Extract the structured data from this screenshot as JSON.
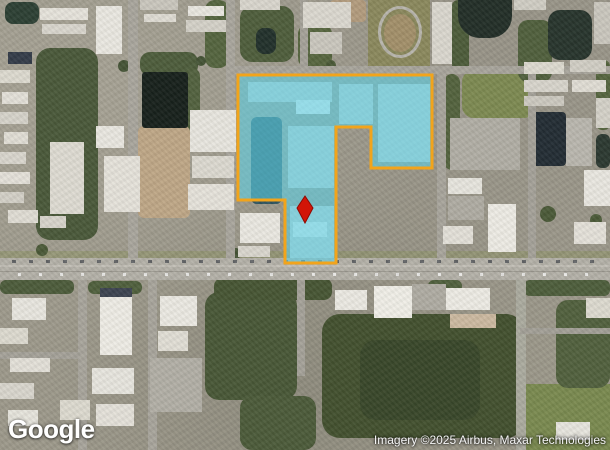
{
  "map": {
    "width": 610,
    "height": 450,
    "view_type": "satellite",
    "logo_text": "Google",
    "attribution_text": "Imagery ©2025 Airbus, Maxar Technologies",
    "parcel": {
      "stroke": "#F2A41B",
      "stroke_width": 3,
      "fill": "#3FC8E0",
      "fill_opacity": 0.5,
      "lighten_fill": "#FFFFFF",
      "lighten_opacity": 0.18,
      "points": [
        [
          238,
          75
        ],
        [
          432,
          75
        ],
        [
          432,
          168
        ],
        [
          371,
          168
        ],
        [
          371,
          127
        ],
        [
          336,
          127
        ],
        [
          336,
          263
        ],
        [
          285,
          263
        ],
        [
          285,
          200
        ],
        [
          238,
          200
        ]
      ]
    },
    "marker": {
      "color": "#D21507",
      "stroke": "#8F0A03",
      "points": [
        [
          305,
          196
        ],
        [
          313,
          208
        ],
        [
          305,
          223
        ],
        [
          297,
          208
        ]
      ]
    }
  },
  "features": {
    "ground": [
      {
        "x": 36,
        "y": 48,
        "w": 62,
        "h": 192,
        "c": "#4a593a",
        "rad": 14,
        "cls": "veg-shade"
      },
      {
        "x": 140,
        "y": 52,
        "w": 58,
        "h": 24,
        "c": "#4e5d3c",
        "rad": 10,
        "cls": "veg-shade"
      },
      {
        "x": 184,
        "y": 68,
        "w": 16,
        "h": 84,
        "c": "#53623f",
        "rad": 8
      },
      {
        "x": 205,
        "y": 0,
        "w": 24,
        "h": 68,
        "c": "#55653f",
        "rad": 10,
        "cls": "veg-shade"
      },
      {
        "x": 240,
        "y": 6,
        "w": 54,
        "h": 56,
        "c": "#4f5e3c",
        "rad": 12,
        "cls": "veg-shade"
      },
      {
        "x": 298,
        "y": 24,
        "w": 34,
        "h": 44,
        "c": "#57663f",
        "rad": 10
      },
      {
        "x": 368,
        "y": 0,
        "w": 62,
        "h": 68,
        "c": "#8b895d"
      },
      {
        "x": 452,
        "y": 0,
        "w": 17,
        "h": 72,
        "c": "#4d5c3a",
        "rad": 6
      },
      {
        "x": 462,
        "y": 70,
        "w": 74,
        "h": 48,
        "c": "#7d8a52",
        "rad": 12
      },
      {
        "x": 518,
        "y": 20,
        "w": 34,
        "h": 62,
        "c": "#51603d",
        "rad": 10
      },
      {
        "x": 596,
        "y": 60,
        "w": 14,
        "h": 70,
        "c": "#56653f",
        "rad": 6
      },
      {
        "x": 138,
        "y": 126,
        "w": 52,
        "h": 92,
        "c": "#bfa787",
        "rad": 6
      },
      {
        "x": 330,
        "y": 0,
        "w": 36,
        "h": 22,
        "c": "#b39c7e",
        "rad": 4
      },
      {
        "x": 444,
        "y": 74,
        "w": 16,
        "h": 96,
        "c": "#54633e",
        "rad": 8
      },
      {
        "x": 322,
        "y": 314,
        "w": 202,
        "h": 124,
        "c": "#43512f",
        "rad": 18,
        "cls": "veg-shade"
      },
      {
        "x": 360,
        "y": 340,
        "w": 120,
        "h": 80,
        "c": "#39472a",
        "rad": 16
      },
      {
        "x": 205,
        "y": 292,
        "w": 92,
        "h": 108,
        "c": "#495837",
        "rad": 14,
        "cls": "veg-shade"
      },
      {
        "x": 240,
        "y": 396,
        "w": 76,
        "h": 54,
        "c": "#4c5b3a",
        "rad": 12
      },
      {
        "x": 526,
        "y": 384,
        "w": 84,
        "h": 66,
        "c": "#7a8a50"
      },
      {
        "x": 556,
        "y": 300,
        "w": 54,
        "h": 88,
        "c": "#52613e",
        "rad": 12,
        "cls": "veg-shade"
      },
      {
        "x": 0,
        "y": 251,
        "w": 610,
        "h": 7,
        "c": "#8e9466",
        "op": 0.55
      },
      {
        "x": 0,
        "y": 280,
        "w": 74,
        "h": 14,
        "c": "#4d5c3b",
        "rad": 6
      },
      {
        "x": 88,
        "y": 281,
        "w": 54,
        "h": 13,
        "c": "#50603d",
        "rad": 6
      },
      {
        "x": 214,
        "y": 278,
        "w": 118,
        "h": 22,
        "c": "#475634",
        "rad": 8
      },
      {
        "x": 428,
        "y": 280,
        "w": 34,
        "h": 14,
        "c": "#51613e",
        "rad": 6
      },
      {
        "x": 524,
        "y": 280,
        "w": 86,
        "h": 16,
        "c": "#4e5e3c",
        "rad": 6
      },
      {
        "x": 384,
        "y": 14,
        "w": 32,
        "h": 38,
        "c": "#a3906a",
        "rad": "50%"
      },
      {
        "x": 118,
        "y": 60,
        "w": 12,
        "h": 12,
        "c": "#455436",
        "rad": "50%"
      },
      {
        "x": 196,
        "y": 56,
        "w": 10,
        "h": 10,
        "c": "#455436",
        "rad": "50%"
      },
      {
        "x": 214,
        "y": 232,
        "w": 14,
        "h": 14,
        "c": "#45543­6",
        "rad": "50%"
      },
      {
        "x": 230,
        "y": 248,
        "w": 11,
        "h": 11,
        "c": "#455436",
        "rad": "50%"
      },
      {
        "x": 466,
        "y": 178,
        "w": 12,
        "h": 12,
        "c": "#4b5a38",
        "rad": "50%"
      },
      {
        "x": 540,
        "y": 206,
        "w": 16,
        "h": 16,
        "c": "#4b5a38",
        "rad": "50%"
      },
      {
        "x": 590,
        "y": 214,
        "w": 12,
        "h": 12,
        "c": "#4b5a38",
        "rad": "50%"
      },
      {
        "x": 326,
        "y": 60,
        "w": 10,
        "h": 10,
        "c": "#4b5a38",
        "rad": "50%"
      },
      {
        "x": 36,
        "y": 244,
        "w": 12,
        "h": 12,
        "c": "#4b5a38",
        "rad": "50%"
      }
    ],
    "water": [
      {
        "x": 5,
        "y": 2,
        "w": 34,
        "h": 22,
        "c": "#2d4034",
        "rad": 8
      },
      {
        "x": 142,
        "y": 72,
        "w": 46,
        "h": 56,
        "c": "#18211c",
        "rad": 3
      },
      {
        "x": 458,
        "y": 0,
        "w": 54,
        "h": 38,
        "c": "#232f28",
        "rad": "0 0 22px 22px"
      },
      {
        "x": 548,
        "y": 10,
        "w": 44,
        "h": 50,
        "c": "#28352d",
        "rad": 12
      },
      {
        "x": 596,
        "y": 134,
        "w": 14,
        "h": 34,
        "c": "#2c3931",
        "rad": 6
      },
      {
        "x": 256,
        "y": 28,
        "w": 20,
        "h": 26,
        "c": "#22312b",
        "rad": 8
      },
      {
        "x": 251,
        "y": 117,
        "w": 31,
        "h": 87,
        "c": "#2f5560",
        "rad": 6
      },
      {
        "x": 532,
        "y": 112,
        "w": 34,
        "h": 54,
        "c": "#232d34",
        "rad": 4
      }
    ],
    "roads": [
      {
        "x": 0,
        "y": 258,
        "w": 610,
        "h": 22,
        "c": "#b4b1a8"
      },
      {
        "x": 0,
        "y": 265,
        "w": 610,
        "h": 2,
        "c": "#c6c3b9",
        "op": 0.8
      },
      {
        "x": 0,
        "y": 271,
        "w": 610,
        "h": 1,
        "c": "#908d85",
        "op": 0.7
      },
      {
        "x": 12,
        "y": 260,
        "w": 588,
        "h": 3,
        "cls": "traffic"
      },
      {
        "x": 18,
        "y": 273,
        "w": 580,
        "h": 3,
        "cls": "traffic2"
      },
      {
        "x": 128,
        "y": 0,
        "w": 10,
        "h": 258,
        "c": "#a9a69d"
      },
      {
        "x": 226,
        "y": 0,
        "w": 9,
        "h": 258,
        "c": "#a9a69d"
      },
      {
        "x": 300,
        "y": 0,
        "w": 8,
        "h": 66,
        "c": "#a5a299"
      },
      {
        "x": 232,
        "y": 66,
        "w": 378,
        "h": 8,
        "c": "#a8a59c"
      },
      {
        "x": 437,
        "y": 72,
        "w": 9,
        "h": 186,
        "c": "#a8a59c"
      },
      {
        "x": 528,
        "y": 66,
        "w": 8,
        "h": 192,
        "c": "#a5a299"
      },
      {
        "x": 78,
        "y": 280,
        "w": 9,
        "h": 170,
        "c": "#a8a59c"
      },
      {
        "x": 148,
        "y": 280,
        "w": 9,
        "h": 170,
        "c": "#a8a59c"
      },
      {
        "x": 516,
        "y": 280,
        "w": 10,
        "h": 170,
        "c": "#abab9f"
      },
      {
        "x": 297,
        "y": 280,
        "w": 8,
        "h": 96,
        "c": "#a5a299"
      },
      {
        "x": 0,
        "y": 352,
        "w": 80,
        "h": 7,
        "c": "#a5a299"
      },
      {
        "x": 520,
        "y": 328,
        "w": 90,
        "h": 6,
        "c": "#a3a097"
      }
    ],
    "buildings": [
      {
        "x": 40,
        "y": 8,
        "w": 48,
        "h": 12,
        "c": "#e6e3db"
      },
      {
        "x": 42,
        "y": 24,
        "w": 44,
        "h": 10,
        "c": "#d9d6cd"
      },
      {
        "x": 96,
        "y": 6,
        "w": 26,
        "h": 48,
        "c": "#eae8e1"
      },
      {
        "x": 140,
        "y": 0,
        "w": 38,
        "h": 10,
        "c": "#cac7be"
      },
      {
        "x": 144,
        "y": 14,
        "w": 32,
        "h": 8,
        "c": "#dfdcd3"
      },
      {
        "x": 188,
        "y": 6,
        "w": 36,
        "h": 10,
        "c": "#e9e7e0"
      },
      {
        "x": 186,
        "y": 20,
        "w": 40,
        "h": 12,
        "c": "#d4d1c8"
      },
      {
        "x": 240,
        "y": 0,
        "w": 40,
        "h": 10,
        "c": "#d9d6cd"
      },
      {
        "x": 8,
        "y": 52,
        "w": 24,
        "h": 12,
        "c": "#343c49"
      },
      {
        "x": 0,
        "y": 70,
        "w": 30,
        "h": 13,
        "c": "#dddacf"
      },
      {
        "x": 2,
        "y": 92,
        "w": 26,
        "h": 12,
        "c": "#e3e0d8"
      },
      {
        "x": 0,
        "y": 112,
        "w": 28,
        "h": 12,
        "c": "#d6d3ca"
      },
      {
        "x": 4,
        "y": 132,
        "w": 24,
        "h": 12,
        "c": "#e1ded5"
      },
      {
        "x": 0,
        "y": 152,
        "w": 26,
        "h": 12,
        "c": "#d9d6cd"
      },
      {
        "x": 0,
        "y": 172,
        "w": 30,
        "h": 12,
        "c": "#e4e1d9"
      },
      {
        "x": 0,
        "y": 192,
        "w": 24,
        "h": 11,
        "c": "#d3d0c7"
      },
      {
        "x": 8,
        "y": 210,
        "w": 30,
        "h": 13,
        "c": "#e0ddd4"
      },
      {
        "x": 40,
        "y": 216,
        "w": 26,
        "h": 12,
        "c": "#d7d4cb"
      },
      {
        "x": 50,
        "y": 142,
        "w": 34,
        "h": 72,
        "c": "#dedbd2",
        "cls": "rows"
      },
      {
        "x": 104,
        "y": 156,
        "w": 36,
        "h": 56,
        "c": "#e5e2da",
        "cls": "rows"
      },
      {
        "x": 96,
        "y": 126,
        "w": 28,
        "h": 22,
        "c": "#e9e7e0"
      },
      {
        "x": 190,
        "y": 110,
        "w": 46,
        "h": 42,
        "c": "#e8e6df"
      },
      {
        "x": 192,
        "y": 156,
        "w": 42,
        "h": 22,
        "c": "#dcd9d0"
      },
      {
        "x": 188,
        "y": 184,
        "w": 46,
        "h": 26,
        "c": "#e5e2da"
      },
      {
        "x": 240,
        "y": 213,
        "w": 40,
        "h": 30,
        "c": "#eae8e1"
      },
      {
        "x": 238,
        "y": 246,
        "w": 32,
        "h": 11,
        "c": "#d9d6cd"
      },
      {
        "x": 303,
        "y": 2,
        "w": 48,
        "h": 26,
        "c": "#dbd8cf"
      },
      {
        "x": 310,
        "y": 32,
        "w": 32,
        "h": 22,
        "c": "#cac7be"
      },
      {
        "x": 432,
        "y": 2,
        "w": 20,
        "h": 62,
        "c": "#dad7ce",
        "cls": "rows"
      },
      {
        "x": 514,
        "y": 0,
        "w": 32,
        "h": 10,
        "c": "#d0cdc4"
      },
      {
        "x": 594,
        "y": 2,
        "w": 16,
        "h": 42,
        "c": "#cac7be"
      },
      {
        "x": 524,
        "y": 62,
        "w": 40,
        "h": 12,
        "c": "#dddacf"
      },
      {
        "x": 570,
        "y": 60,
        "w": 36,
        "h": 12,
        "c": "#d1cec5"
      },
      {
        "x": 524,
        "y": 80,
        "w": 44,
        "h": 12,
        "c": "#d8d5cc"
      },
      {
        "x": 572,
        "y": 80,
        "w": 34,
        "h": 12,
        "c": "#e0ddd4"
      },
      {
        "x": 524,
        "y": 96,
        "w": 40,
        "h": 10,
        "c": "#ccc9c0"
      },
      {
        "x": 566,
        "y": 118,
        "w": 26,
        "h": 48,
        "c": "#bab7ae"
      },
      {
        "x": 596,
        "y": 98,
        "w": 14,
        "h": 30,
        "c": "#d4d1c8"
      },
      {
        "x": 448,
        "y": 178,
        "w": 34,
        "h": 16,
        "c": "#e7e5de"
      },
      {
        "x": 443,
        "y": 226,
        "w": 30,
        "h": 18,
        "c": "#e3e0d8"
      },
      {
        "x": 488,
        "y": 204,
        "w": 28,
        "h": 48,
        "c": "#edebe4"
      },
      {
        "x": 584,
        "y": 170,
        "w": 26,
        "h": 36,
        "c": "#e9e7e0"
      },
      {
        "x": 574,
        "y": 222,
        "w": 32,
        "h": 22,
        "c": "#e4e1d9"
      },
      {
        "x": 450,
        "y": 118,
        "w": 70,
        "h": 52,
        "c": "#b1aea5",
        "cls": "lot"
      },
      {
        "x": 448,
        "y": 196,
        "w": 36,
        "h": 24,
        "c": "#afaca3",
        "cls": "lot"
      },
      {
        "x": 12,
        "y": 298,
        "w": 34,
        "h": 22,
        "c": "#e8e6df"
      },
      {
        "x": 0,
        "y": 328,
        "w": 28,
        "h": 16,
        "c": "#dddacf"
      },
      {
        "x": 10,
        "y": 358,
        "w": 40,
        "h": 14,
        "c": "#e3e0d8"
      },
      {
        "x": 0,
        "y": 383,
        "w": 34,
        "h": 16,
        "c": "#d9d6cd"
      },
      {
        "x": 8,
        "y": 410,
        "w": 30,
        "h": 16,
        "c": "#e6e4dc"
      },
      {
        "x": 100,
        "y": 288,
        "w": 32,
        "h": 9,
        "c": "#3d4451"
      },
      {
        "x": 100,
        "y": 297,
        "w": 32,
        "h": 58,
        "c": "#eeece5"
      },
      {
        "x": 160,
        "y": 296,
        "w": 37,
        "h": 30,
        "c": "#ebe9e2"
      },
      {
        "x": 158,
        "y": 331,
        "w": 30,
        "h": 20,
        "c": "#e1ded5"
      },
      {
        "x": 92,
        "y": 368,
        "w": 42,
        "h": 26,
        "c": "#e7e5de"
      },
      {
        "x": 60,
        "y": 400,
        "w": 30,
        "h": 20,
        "c": "#dddacf"
      },
      {
        "x": 96,
        "y": 404,
        "w": 38,
        "h": 22,
        "c": "#e4e1d9"
      },
      {
        "x": 150,
        "y": 358,
        "w": 52,
        "h": 54,
        "c": "#b2afa6",
        "cls": "lot"
      },
      {
        "x": 335,
        "y": 290,
        "w": 32,
        "h": 20,
        "c": "#ebe9e2"
      },
      {
        "x": 374,
        "y": 286,
        "w": 38,
        "h": 32,
        "c": "#f0eee7"
      },
      {
        "x": 446,
        "y": 288,
        "w": 44,
        "h": 22,
        "c": "#edebe4"
      },
      {
        "x": 450,
        "y": 314,
        "w": 46,
        "h": 14,
        "c": "#ccbaa1"
      },
      {
        "x": 556,
        "y": 422,
        "w": 34,
        "h": 18,
        "c": "#e7e5de"
      },
      {
        "x": 586,
        "y": 298,
        "w": 24,
        "h": 20,
        "c": "#dddacf"
      },
      {
        "x": 412,
        "y": 284,
        "w": 34,
        "h": 26,
        "c": "#afaca3",
        "cls": "lot"
      },
      {
        "x": 378,
        "y": 6,
        "w": 44,
        "h": 52,
        "cls": "oval",
        "rad": "50%"
      },
      {
        "x": 248,
        "y": 82,
        "w": 84,
        "h": 20,
        "c": "#c9cfcc",
        "cls": "rows-c"
      },
      {
        "x": 339,
        "y": 84,
        "w": 34,
        "h": 40,
        "c": "#c9cfcc",
        "cls": "rows-c"
      },
      {
        "x": 288,
        "y": 126,
        "w": 46,
        "h": 62,
        "c": "#c9cfcc",
        "cls": "rows-c"
      },
      {
        "x": 378,
        "y": 84,
        "w": 52,
        "h": 78,
        "c": "#c9cfcc",
        "cls": "rows-c"
      },
      {
        "x": 290,
        "y": 206,
        "w": 44,
        "h": 52,
        "c": "#c9cfcc",
        "cls": "rows-c"
      },
      {
        "x": 296,
        "y": 100,
        "w": 34,
        "h": 14,
        "c": "#eef0ee"
      },
      {
        "x": 293,
        "y": 222,
        "w": 34,
        "h": 15,
        "c": "#eaeeec"
      }
    ]
  }
}
